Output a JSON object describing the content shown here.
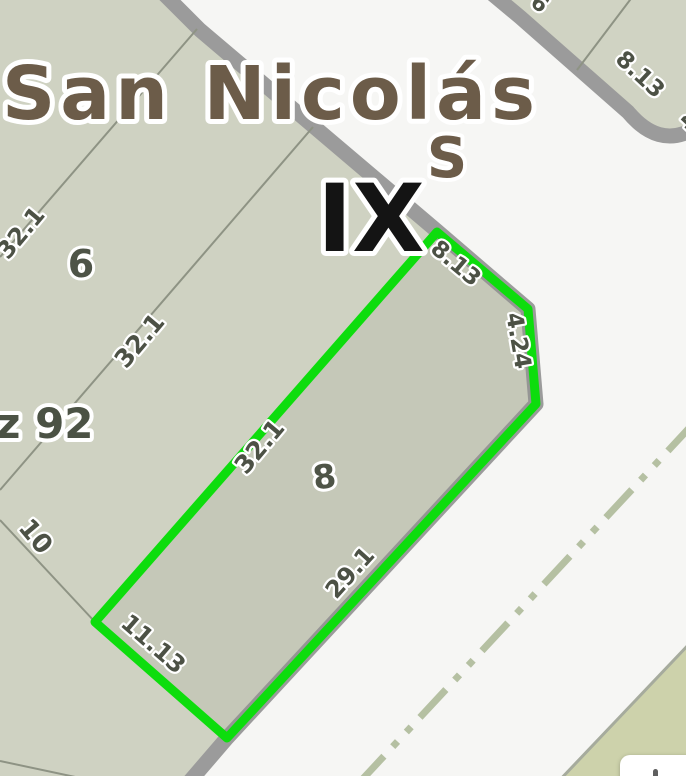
{
  "map": {
    "street_name": "San Nicolás",
    "street_initial": "S",
    "zone_label": "IX",
    "block_label": "z 92",
    "parcels": {
      "parcel6": "6",
      "parcel8": "8",
      "parcel10": "10"
    },
    "dimensions": {
      "upper_32": "32.1",
      "mid_32": "32.1",
      "parcel8_left": "32.1",
      "parcel8_front": "8.13",
      "parcel8_chamfer": "4.24",
      "parcel8_right": "29.1",
      "parcel8_bottom": "11.13",
      "ne_block_front": "8.13",
      "partial_4": "4",
      "partial_6": "6"
    },
    "colors": {
      "highlight_green": "#0ddd0d",
      "parcel_fill": "#cfd2c2",
      "parcel_fill_alt": "#cdd2ab",
      "road_gray": "#9b9b9b",
      "street_white": "#f6f6f4",
      "street_text_brown": "#6c5c49",
      "zone_text_black": "#141414",
      "dimension_text": "#4c5145",
      "centerline_green": "#b5c0a2",
      "thin_line": "#8e9384"
    }
  }
}
